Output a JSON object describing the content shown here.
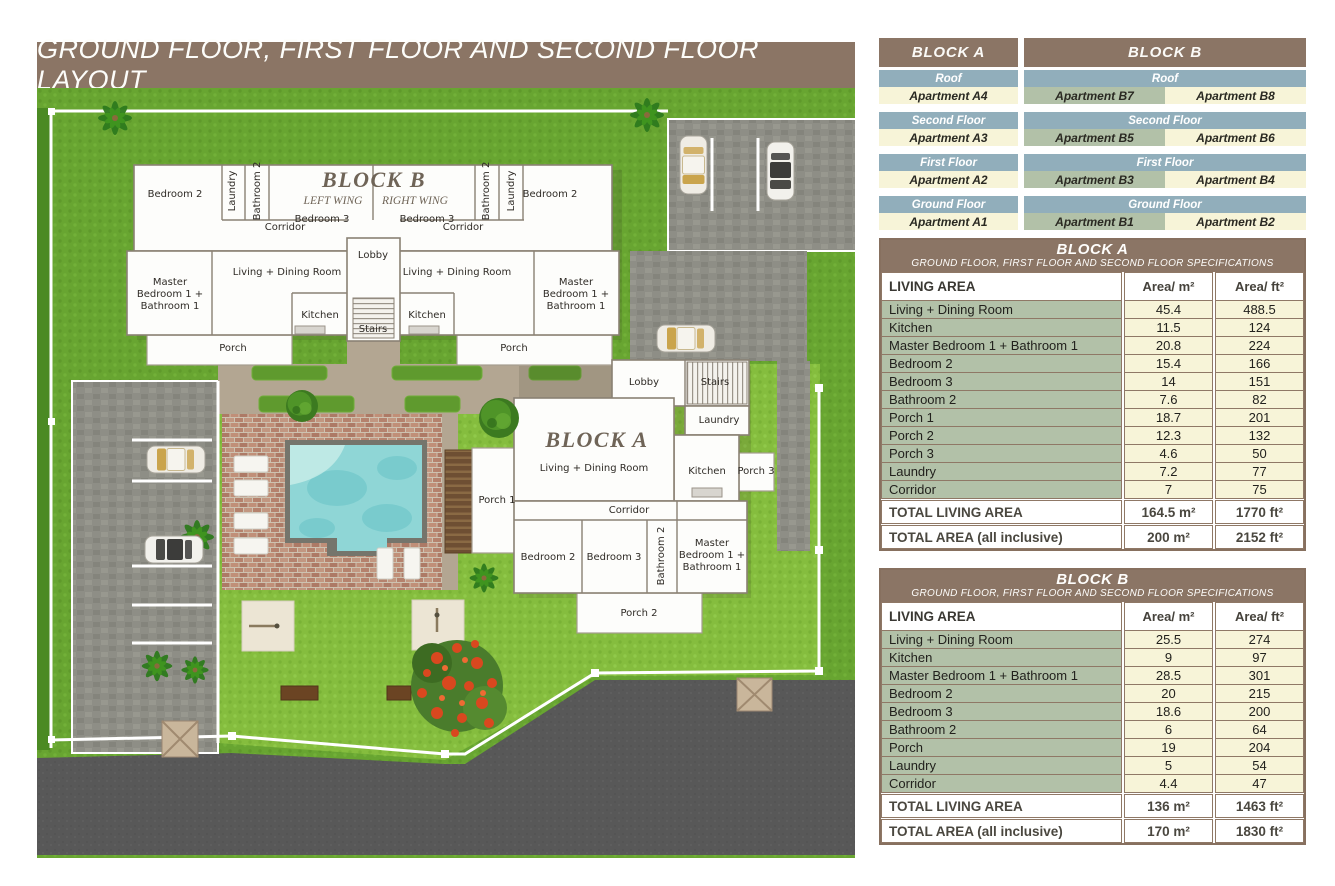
{
  "title": "GROUND FLOOR, FIRST FLOOR AND SECOND FLOOR LAYOUT",
  "colors": {
    "header_brown": "#8b7565",
    "floor_bar_blue": "#91aebb",
    "cell_cream": "#f7f4d8",
    "cell_sage": "#b2c1a8",
    "table_frame_brown": "#87705f",
    "pool_water": "#8fd6d6",
    "lawn_green": "#85bd3e",
    "road_asphalt": "#585858"
  },
  "floors": {
    "block_a": {
      "header": "BLOCK A",
      "groups": [
        {
          "floor": "Roof",
          "apartments": [
            "Apartment A4"
          ]
        },
        {
          "floor": "Second Floor",
          "apartments": [
            "Apartment A3"
          ]
        },
        {
          "floor": "First Floor",
          "apartments": [
            "Apartment A2"
          ]
        },
        {
          "floor": "Ground Floor",
          "apartments": [
            "Apartment A1"
          ]
        }
      ]
    },
    "block_b": {
      "header": "BLOCK B",
      "groups": [
        {
          "floor": "Roof",
          "apartments": [
            "Apartment B7",
            "Apartment B8"
          ]
        },
        {
          "floor": "Second Floor",
          "apartments": [
            "Apartment B5",
            "Apartment B6"
          ]
        },
        {
          "floor": "First Floor",
          "apartments": [
            "Apartment B3",
            "Apartment B4"
          ]
        },
        {
          "floor": "Ground Floor",
          "apartments": [
            "Apartment B1",
            "Apartment B2"
          ]
        }
      ]
    }
  },
  "spec_a": {
    "title": "BLOCK A",
    "subtitle": "GROUND FLOOR, FIRST FLOOR AND SECOND FLOOR SPECIFICATIONS",
    "columns": [
      "LIVING AREA",
      "Area/ m²",
      "Area/ ft²"
    ],
    "rows": [
      [
        "Living + Dining Room",
        "45.4",
        "488.5"
      ],
      [
        "Kitchen",
        "11.5",
        "124"
      ],
      [
        "Master Bedroom 1 + Bathroom 1",
        "20.8",
        "224"
      ],
      [
        "Bedroom 2",
        "15.4",
        "166"
      ],
      [
        "Bedroom 3",
        "14",
        "151"
      ],
      [
        "Bathroom 2",
        "7.6",
        "82"
      ],
      [
        "Porch 1",
        "18.7",
        "201"
      ],
      [
        "Porch 2",
        "12.3",
        "132"
      ],
      [
        "Porch 3",
        "4.6",
        "50"
      ],
      [
        "Laundry",
        "7.2",
        "77"
      ],
      [
        "Corridor",
        "7",
        "75"
      ]
    ],
    "totals": [
      [
        "TOTAL LIVING AREA",
        "164.5 m²",
        "1770 ft²"
      ],
      [
        "TOTAL AREA (all inclusive)",
        "200 m²",
        "2152 ft²"
      ]
    ]
  },
  "spec_b": {
    "title": "BLOCK B",
    "subtitle": "GROUND FLOOR, FIRST FLOOR AND SECOND FLOOR SPECIFICATIONS",
    "columns": [
      "LIVING AREA",
      "Area/ m²",
      "Area/ ft²"
    ],
    "rows": [
      [
        "Living + Dining Room",
        "25.5",
        "274"
      ],
      [
        "Kitchen",
        "9",
        "97"
      ],
      [
        "Master Bedroom 1 + Bathroom 1",
        "28.5",
        "301"
      ],
      [
        "Bedroom 2",
        "20",
        "215"
      ],
      [
        "Bedroom 3",
        "18.6",
        "200"
      ],
      [
        "Bathroom 2",
        "6",
        "64"
      ],
      [
        "Porch",
        "19",
        "204"
      ],
      [
        "Laundry",
        "5",
        "54"
      ],
      [
        "Corridor",
        "4.4",
        "47"
      ]
    ],
    "totals": [
      [
        "TOTAL LIVING AREA",
        "136 m²",
        "1463 ft²"
      ],
      [
        "TOTAL AREA (all inclusive)",
        "170 m²",
        "1830 ft²"
      ]
    ]
  },
  "plan": {
    "block_b": {
      "title": "BLOCK B",
      "left_wing": "LEFT WING",
      "right_wing": "RIGHT WING",
      "rooms": {
        "bedroom2": "Bedroom 2",
        "laundry": "Laundry",
        "bathroom2": "Bathroom 2",
        "corridor": "Corridor",
        "bedroom3": "Bedroom 3",
        "lobby": "Lobby",
        "living": "Living + Dining Room",
        "master": "Master\nBedroom 1 +\nBathroom 1",
        "kitchen": "Kitchen",
        "stairs": "Stairs",
        "porch": "Porch"
      }
    },
    "block_a": {
      "title": "BLOCK A",
      "rooms": {
        "lobby": "Lobby",
        "stairs": "Stairs",
        "laundry": "Laundry",
        "living": "Living + Dining Room",
        "kitchen": "Kitchen",
        "porch1": "Porch 1",
        "porch2": "Porch 2",
        "porch3": "Porch 3",
        "corridor": "Corridor",
        "bathroom2": "Bathroom 2",
        "bedroom2": "Bedroom 2",
        "bedroom3": "Bedroom 3",
        "master": "Master\nBedroom 1 +\nBathroom 1"
      }
    }
  }
}
